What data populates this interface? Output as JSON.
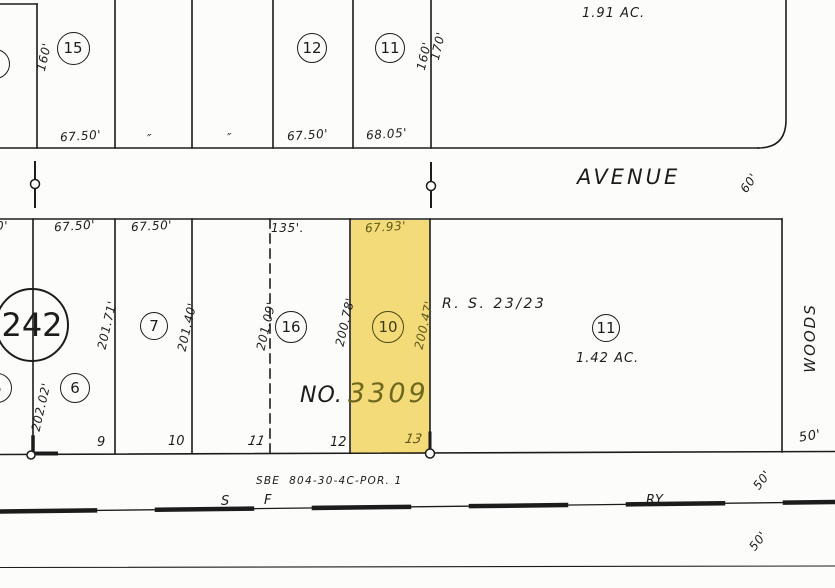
{
  "colors": {
    "paper": "#fcfcfa",
    "ink": "#1c1c1c",
    "highlight_fill": "#f3db79",
    "highlight_text": "#5e5819"
  },
  "top_block": {
    "partial_lot": "9",
    "lot_15": "15",
    "lot_12": "12",
    "lot_11": "11",
    "dim_left_160": "160'",
    "dim_67_50_a": "67.50'",
    "ditto_1": "″",
    "ditto_2": "″",
    "dim_67_50_b": "67.50'",
    "dim_68_05": "68.05'",
    "dim_mid_160": "160'",
    "dim_170": "170'",
    "acreage": "1.91 AC."
  },
  "avenue": {
    "name": "AVENUE",
    "dim_60": "60'"
  },
  "middle_block": {
    "map_ref": "242",
    "partial_lot": "5",
    "lot_6": "6",
    "lot_7": "7",
    "lot_16": "16",
    "lot_10": "10",
    "lot_11": "11",
    "dim_202_02": "202.02'",
    "dim_201_71": "201.71'",
    "dim_201_40": "201.40'",
    "dim_201_09": "201.09'",
    "dim_200_78": "200.78'",
    "dim_200_47": "200.47'",
    "top_dim_partial": "0'",
    "top_dim_67_50_a": "67.50'",
    "top_dim_67_50_b": "67.50'",
    "top_dim_135": "135'.",
    "top_dim_67_93": "67.93'",
    "survey_ref": "R. S. 23/23",
    "acreage": "1.42 AC.",
    "tract_prefix": "NO.",
    "tract_number": "3309",
    "street_right": "WOODS",
    "bottom_lot_9": "9",
    "bottom_lot_10": "10",
    "bottom_lot_11": "11",
    "bottom_lot_12": "12",
    "bottom_lot_13": "13",
    "dim_50_corner": "50'"
  },
  "bottom": {
    "sbe_ref": "SBE  804-30-4C-POR. 1",
    "rail_s": "S",
    "rail_f": "F",
    "rail_ry": "RY",
    "dim_50_upper": "50'",
    "dim_50_lower": "50'"
  }
}
